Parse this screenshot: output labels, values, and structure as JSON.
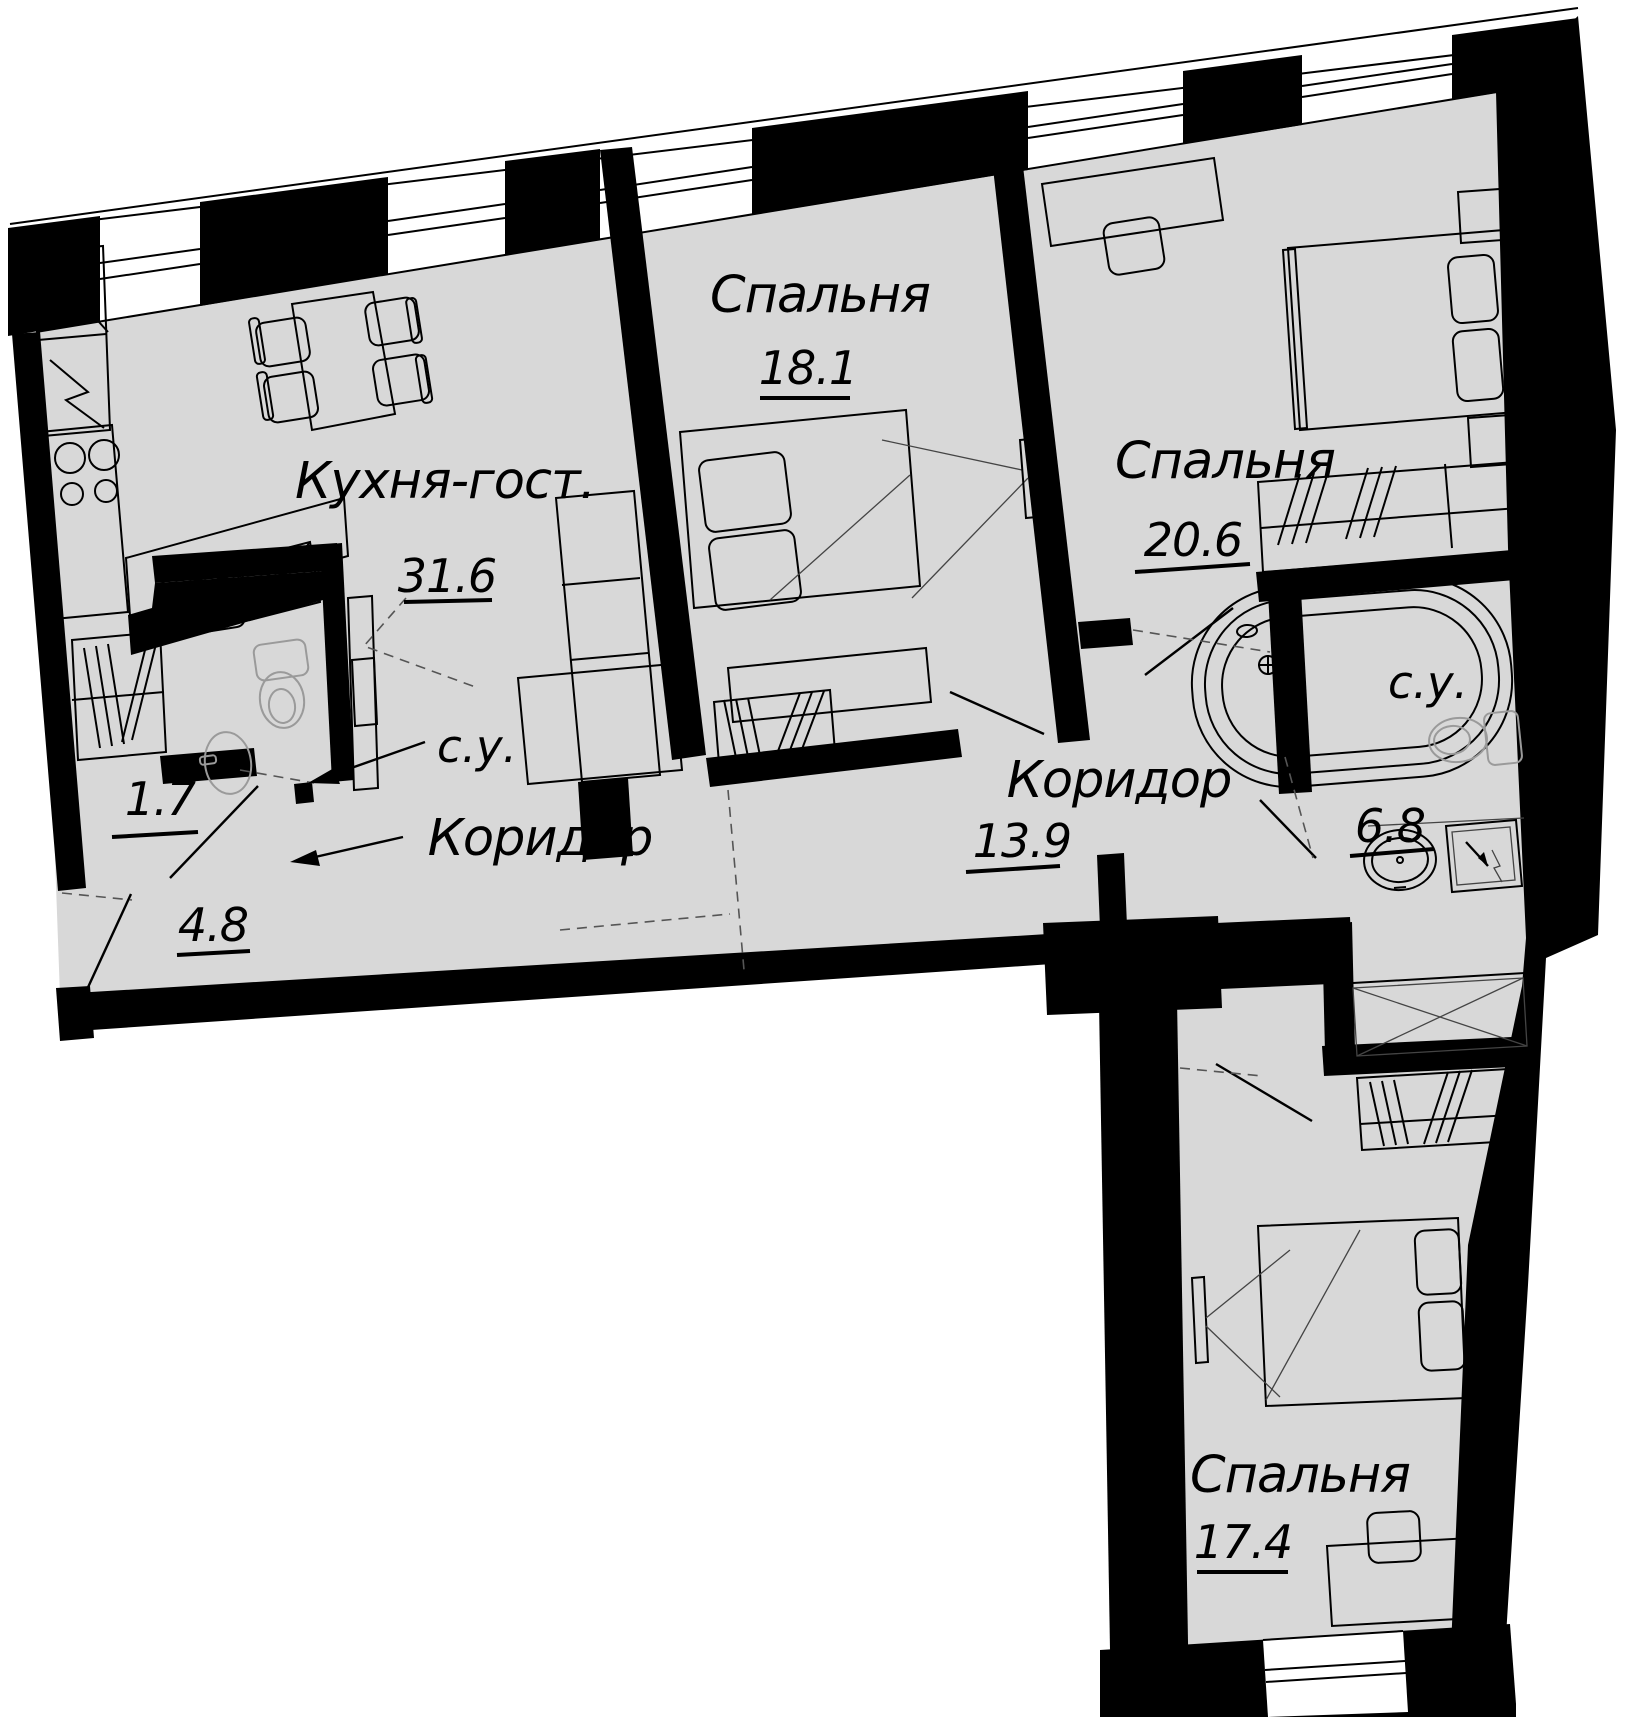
{
  "plan_title": "Apartment floor plan",
  "rooms": {
    "kitchen_living": {
      "label": "Кухня-гост.",
      "area": "31.6"
    },
    "bedroom_1": {
      "label": "Спальня",
      "area": "18.1"
    },
    "bedroom_2": {
      "label": "Спальня",
      "area": "20.6"
    },
    "bedroom_3": {
      "label": "Спальня",
      "area": "17.4"
    },
    "corridor_main": {
      "label": "Коридор",
      "area": "13.9"
    },
    "corridor_entry": {
      "label": "Коридор",
      "area": "4.8"
    },
    "bathroom": {
      "label": "с.у.",
      "area": "6.8"
    },
    "wc": {
      "label": "с.у."
    },
    "storage": {
      "area": "1.7"
    }
  },
  "colors": {
    "floor": "#d8d8d8",
    "walls": "#000000",
    "fixtures": "#9a9a9a"
  }
}
